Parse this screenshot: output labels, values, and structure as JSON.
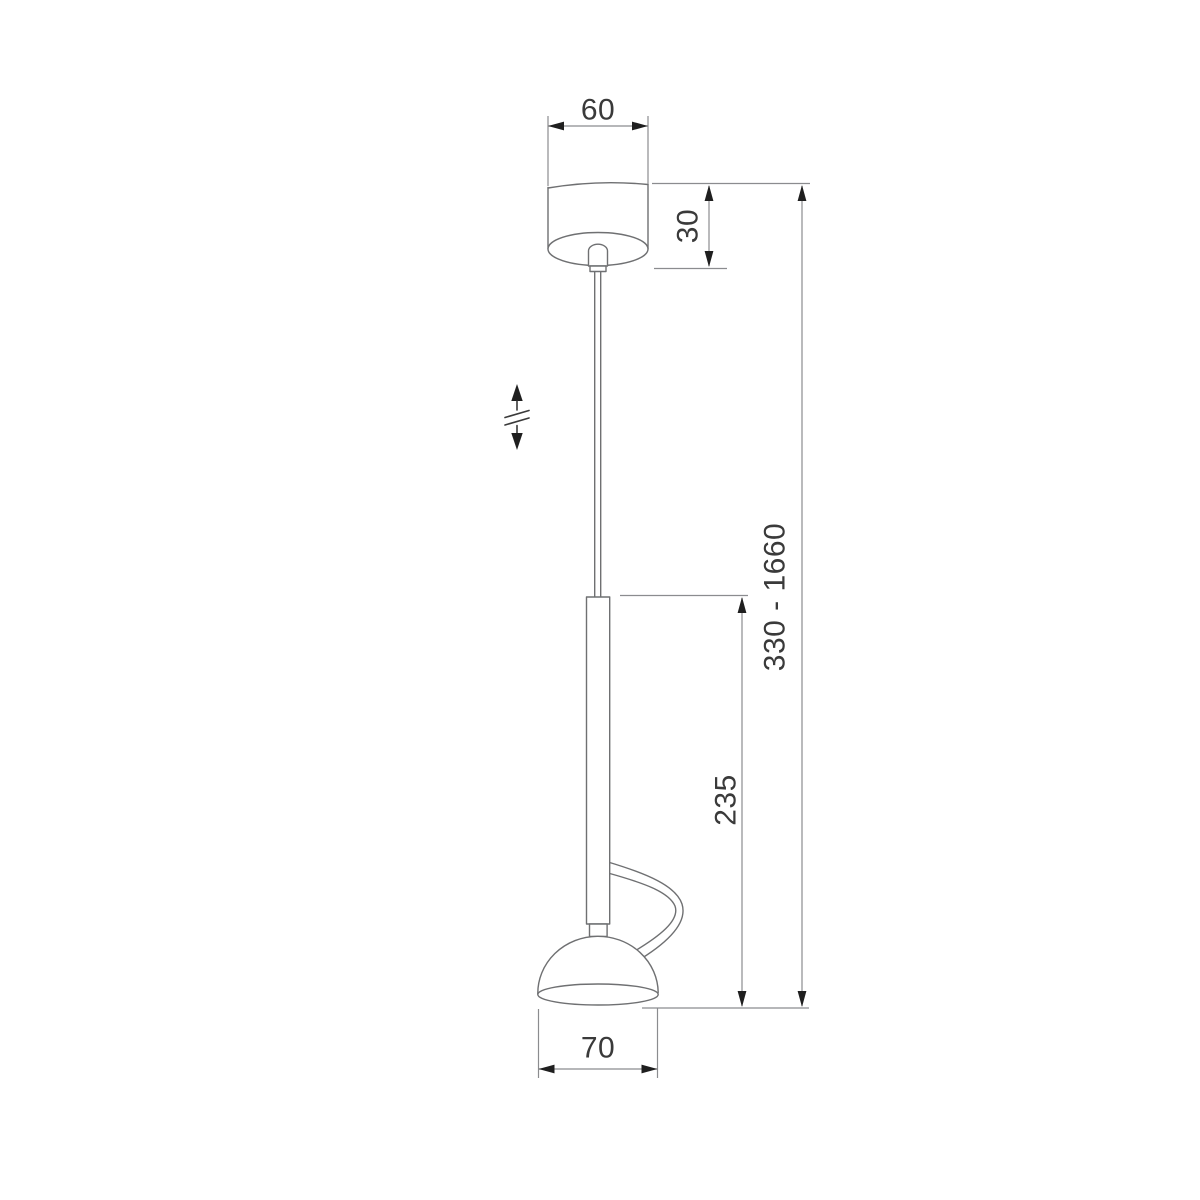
{
  "dimensions": {
    "canopy_width": "60",
    "canopy_height": "30",
    "suspension_height_range": "330 - 1660",
    "fixture_height": "235",
    "shade_width": "70"
  },
  "colors": {
    "background": "#ffffff",
    "outline": "#6f7072",
    "dimension_line": "#8b8c8f",
    "text": "#3a3a3a",
    "arrow": "#1f1f1f"
  },
  "icons": {
    "height_adjust": "height-adjust-double-arrow-icon"
  }
}
